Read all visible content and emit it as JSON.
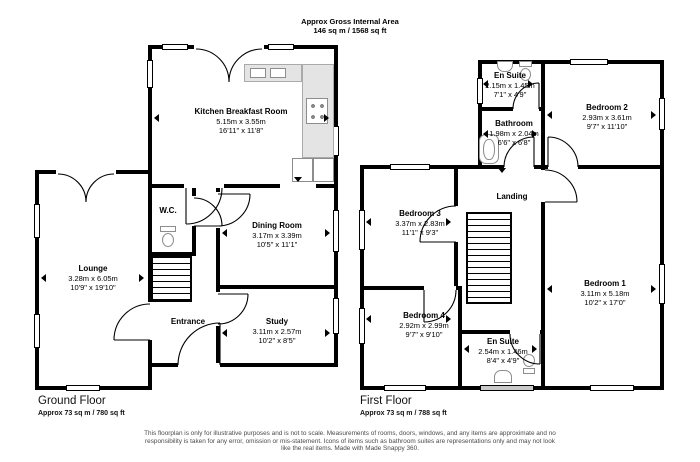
{
  "header": {
    "title": "Approx Gross Internal Area",
    "area": "146 sq m / 1568 sq ft"
  },
  "ground_floor": {
    "title": "Ground Floor",
    "area": "Approx 73 sq m / 780 sq ft",
    "rooms": {
      "kitchen": {
        "name": "Kitchen Breakfast Room",
        "metric": "5.15m x 3.55m",
        "imperial": "16'11\" x 11'8\""
      },
      "lounge": {
        "name": "Lounge",
        "metric": "3.28m x 6.05m",
        "imperial": "10'9\" x 19'10\""
      },
      "wc": {
        "name": "W.C."
      },
      "dining": {
        "name": "Dining Room",
        "metric": "3.17m x 3.39m",
        "imperial": "10'5\" x 11'1\""
      },
      "entrance": {
        "name": "Entrance"
      },
      "study": {
        "name": "Study",
        "metric": "3.11m x 2.57m",
        "imperial": "10'2\" x 8'5\""
      }
    }
  },
  "first_floor": {
    "title": "First Floor",
    "area": "Approx 73 sq m / 788 sq ft",
    "rooms": {
      "ensuite_top": {
        "name": "En Suite",
        "metric": "2.15m x 1.45m",
        "imperial": "7'1\" x 4'9\""
      },
      "bathroom": {
        "name": "Bathroom",
        "metric": "1.98m x 2.04m",
        "imperial": "6'6\" x 6'8\""
      },
      "bedroom2": {
        "name": "Bedroom 2",
        "metric": "2.93m x 3.61m",
        "imperial": "9'7\" x 11'10\""
      },
      "bedroom3": {
        "name": "Bedroom 3",
        "metric": "3.37m x 2.83m",
        "imperial": "11'1\" x 9'3\""
      },
      "landing": {
        "name": "Landing"
      },
      "bedroom1": {
        "name": "Bedroom 1",
        "metric": "3.11m x 5.18m",
        "imperial": "10'2\" x 17'0\""
      },
      "bedroom4": {
        "name": "Bedroom 4",
        "metric": "2.92m x 2.99m",
        "imperial": "9'7\" x 9'10\""
      },
      "ensuite_bottom": {
        "name": "En Suite",
        "metric": "2.54m x 1.46m",
        "imperial": "8'4\" x 4'9\""
      }
    }
  },
  "footer": {
    "disclaimer": "This floorplan is only for illustrative purposes and is not to scale. Measurements of rooms, doors, windows, and any items are approximate and no responsibility is taken for any error, omission or mis-statement. Icons of items such as bathroom suites are representations only and may not look like the real items. Made with Made Snappy 360."
  },
  "colors": {
    "wall": "#000000",
    "counter": "#e4e4e4",
    "fixture_outline": "#8d8d8d"
  }
}
